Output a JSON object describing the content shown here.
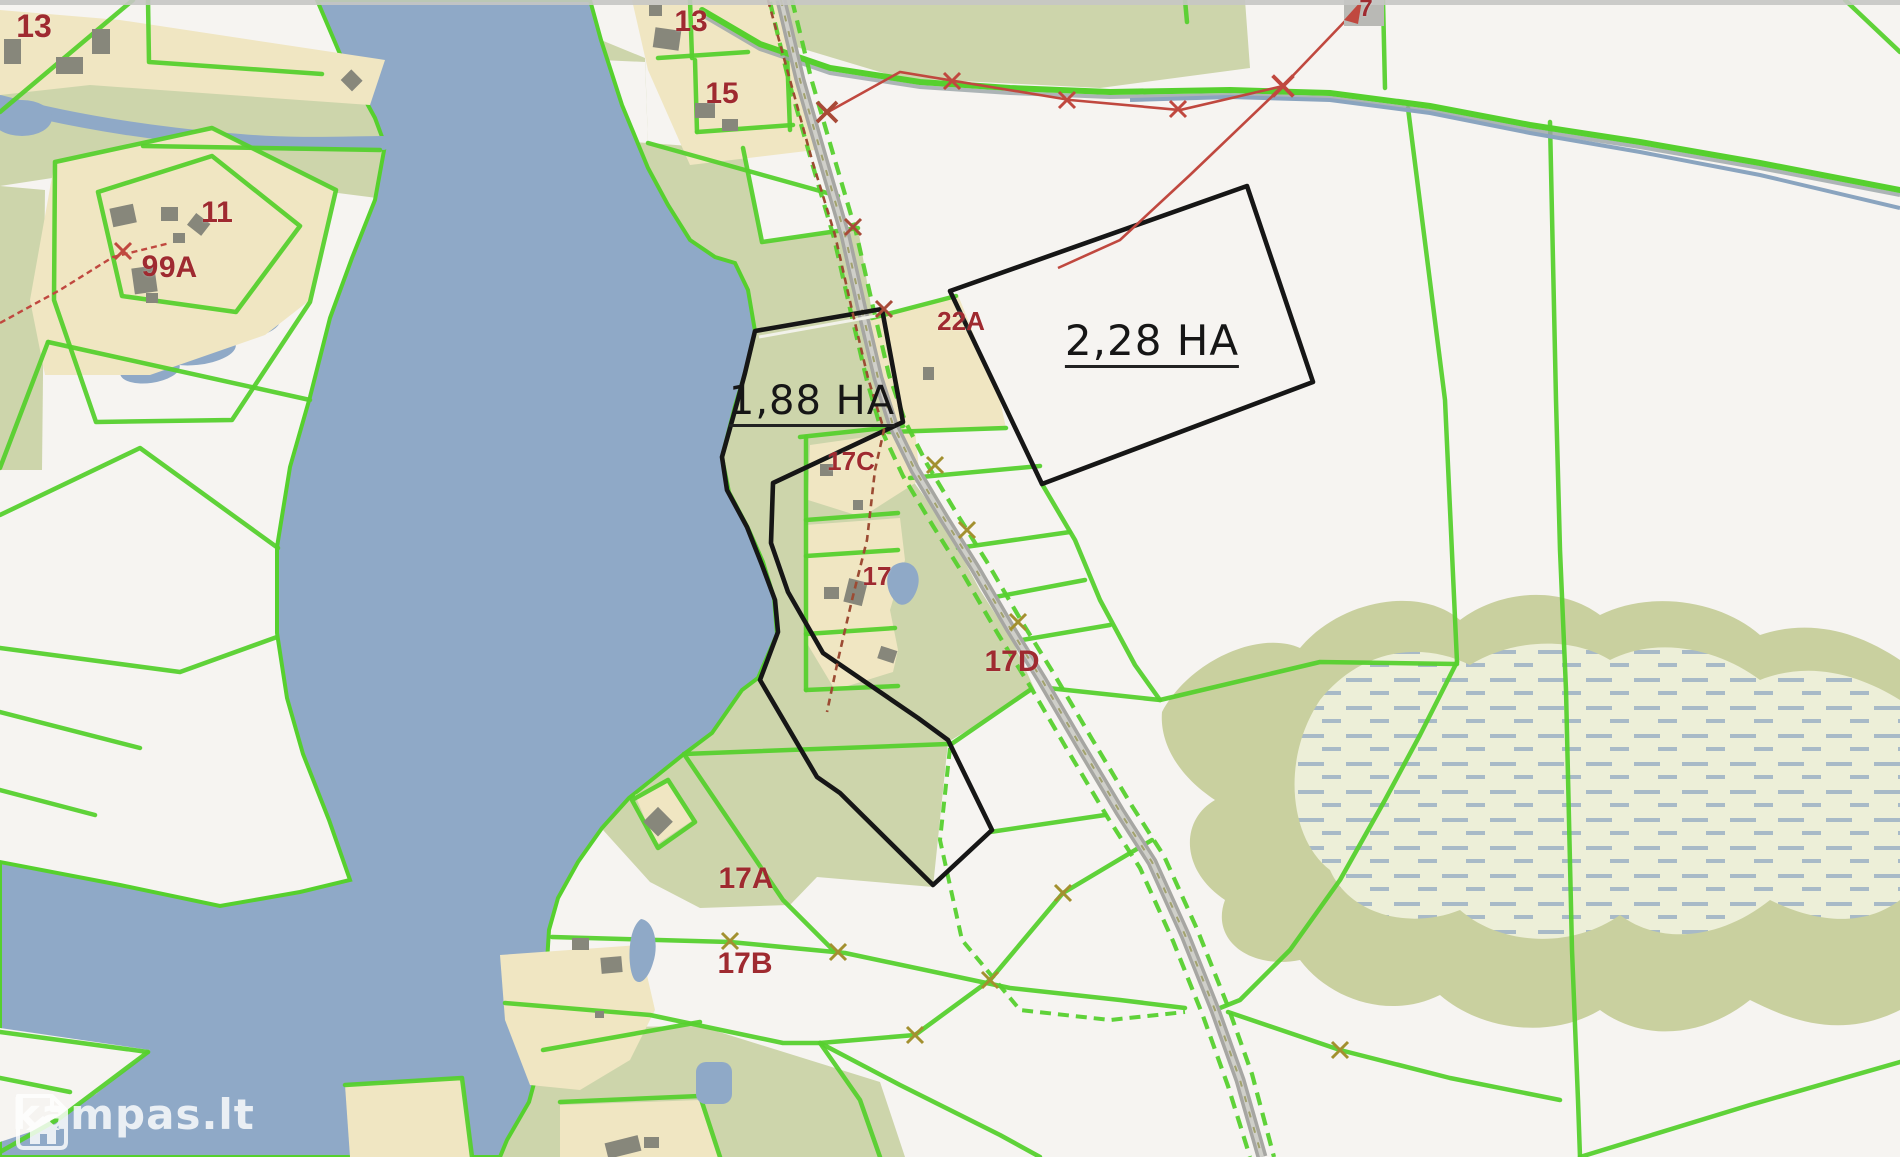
{
  "map": {
    "type": "cadastral-parcel-map",
    "watermark": {
      "text": "kampas.lt",
      "icon": "house-logo-icon"
    },
    "area_annotations": [
      {
        "id": "highlighted-parcel-1",
        "text": "1,88 HA",
        "x": 812,
        "y": 404,
        "size": 40
      },
      {
        "id": "highlighted-parcel-2",
        "text": "2,28 HA",
        "x": 1152,
        "y": 344,
        "size": 42
      }
    ],
    "parcel_labels": [
      {
        "text": "13",
        "x": 34,
        "y": 26,
        "size": 32
      },
      {
        "text": "13",
        "x": 691,
        "y": 22,
        "size": 30
      },
      {
        "text": "15",
        "x": 722,
        "y": 94,
        "size": 30
      },
      {
        "text": "11",
        "x": 217,
        "y": 213,
        "size": 30
      },
      {
        "text": "9",
        "x": 150,
        "y": 267,
        "size": 30
      },
      {
        "text": "9A",
        "x": 178,
        "y": 268,
        "size": 30
      },
      {
        "text": "22A",
        "x": 961,
        "y": 321,
        "size": 26
      },
      {
        "text": "17C",
        "x": 851,
        "y": 461,
        "size": 26
      },
      {
        "text": "17",
        "x": 877,
        "y": 576,
        "size": 26
      },
      {
        "text": "17D",
        "x": 1012,
        "y": 662,
        "size": 30
      },
      {
        "text": "17A",
        "x": 746,
        "y": 879,
        "size": 30
      },
      {
        "text": "17B",
        "x": 745,
        "y": 964,
        "size": 30
      },
      {
        "text": "7",
        "x": 1366,
        "y": 9,
        "size": 24
      }
    ],
    "colors": {
      "water": "#8fa9c7",
      "land": "#f6f4f1",
      "vegetation": "#cdd5ab",
      "marsh_fill": "#edefd8",
      "marsh_dash": "#9db1c4",
      "residential": "#f0e6c2",
      "building": "#87877b",
      "boundary_green": "#56d02e",
      "road_gray": "#a6a6a2",
      "highlight_black": "#161616",
      "powerline_red": "#c0483f",
      "label_red": "#9f2a30",
      "survey_mark_olive": "#a3902f"
    }
  }
}
